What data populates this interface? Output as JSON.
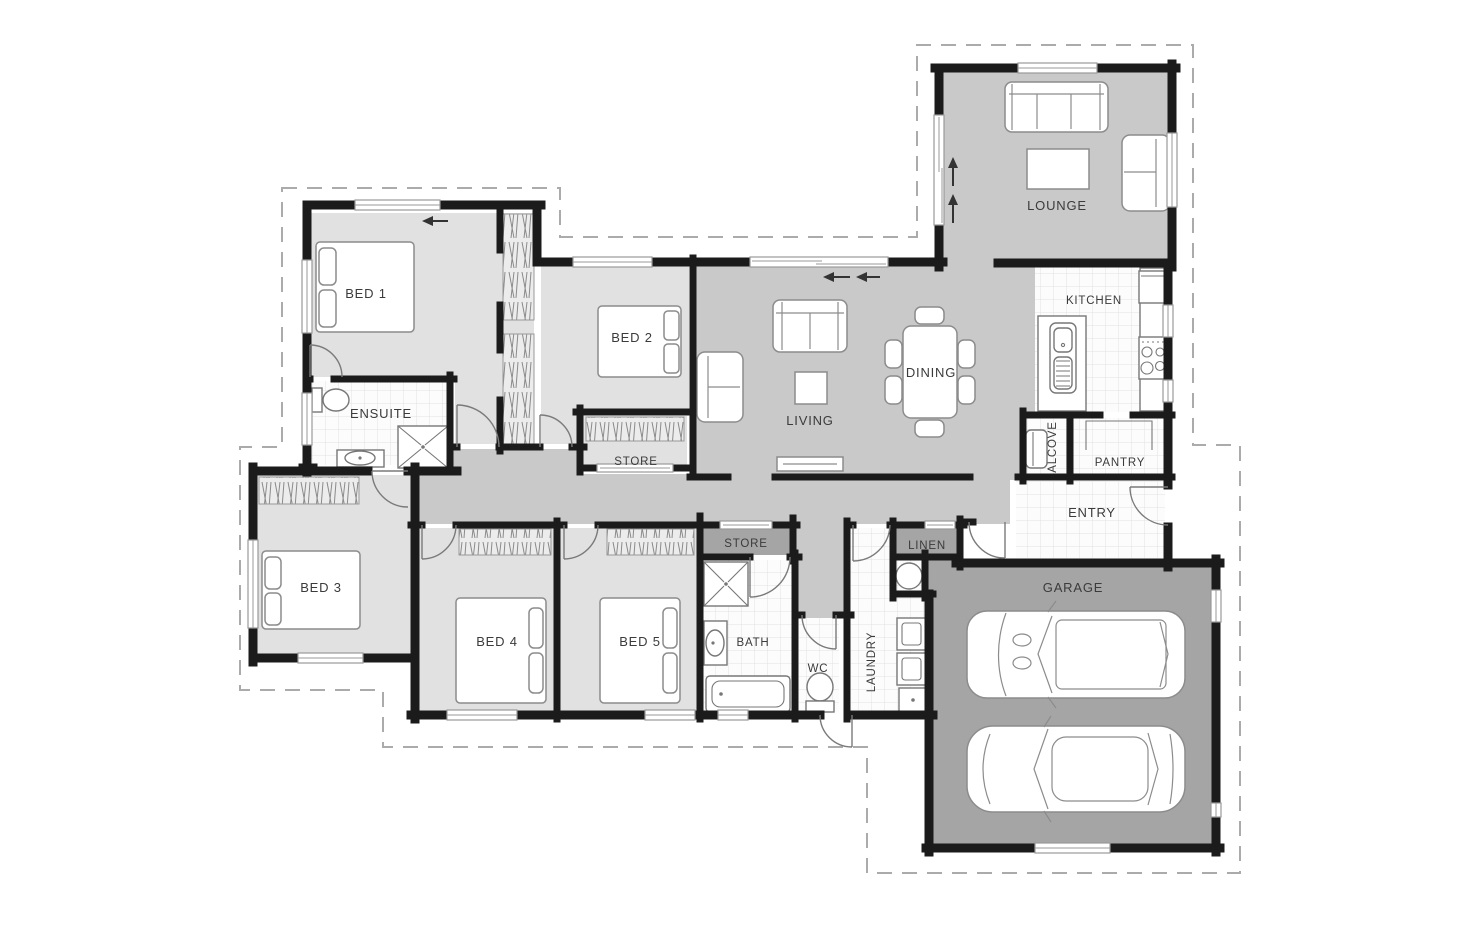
{
  "canvas": {
    "width": 1480,
    "height": 925,
    "background": "#ffffff"
  },
  "palette": {
    "wall": "#1b1b1b",
    "floor_light": "#e1e1e1",
    "floor_mid": "#c9c9c9",
    "floor_dark": "#a5a5a5",
    "tile_floor": "#fcfcfc",
    "tile_grid": "#e2e2e2",
    "furniture_stroke": "#8c8c8c",
    "door_arc": "#7a7a7a",
    "label_text": "#3b3b3b",
    "dashed_boundary": "#ababab"
  },
  "rooms": [
    {
      "label": "BED 1"
    },
    {
      "label": "BED 2"
    },
    {
      "label": "ENSUITE"
    },
    {
      "label": "STORE"
    },
    {
      "label": "LIVING"
    },
    {
      "label": "DINING"
    },
    {
      "label": "KITCHEN"
    },
    {
      "label": "LOUNGE"
    },
    {
      "label": "ALCOVE"
    },
    {
      "label": "PANTRY"
    },
    {
      "label": "ENTRY"
    },
    {
      "label": "LINEN"
    },
    {
      "label": "GARAGE"
    },
    {
      "label": "BED 3"
    },
    {
      "label": "BED 4"
    },
    {
      "label": "BED 5"
    },
    {
      "label": "STORE"
    },
    {
      "label": "BATH"
    },
    {
      "label": "WC"
    },
    {
      "label": "LAUNDRY"
    }
  ],
  "indicators": {
    "living_slider_arrows": [
      "left",
      "left"
    ],
    "lounge_window_arrows": [
      "up",
      "up"
    ],
    "bed1_window_arrow": "left"
  },
  "furniture": [
    "double-bed",
    "single-bed",
    "wardrobe-rail",
    "shelf-rail",
    "sofa",
    "armchair",
    "coffee-table",
    "side-table",
    "tv-unit",
    "dining-table-six-chairs",
    "kitchen-island-sink",
    "cooktop",
    "fridge",
    "pantry-shelf",
    "desk-chair",
    "shower",
    "toilet",
    "vanity-basin",
    "bathtub",
    "washing-machine",
    "dryer",
    "laundry-tub",
    "hot-water-cylinder",
    "suv-car",
    "sedan-car"
  ]
}
